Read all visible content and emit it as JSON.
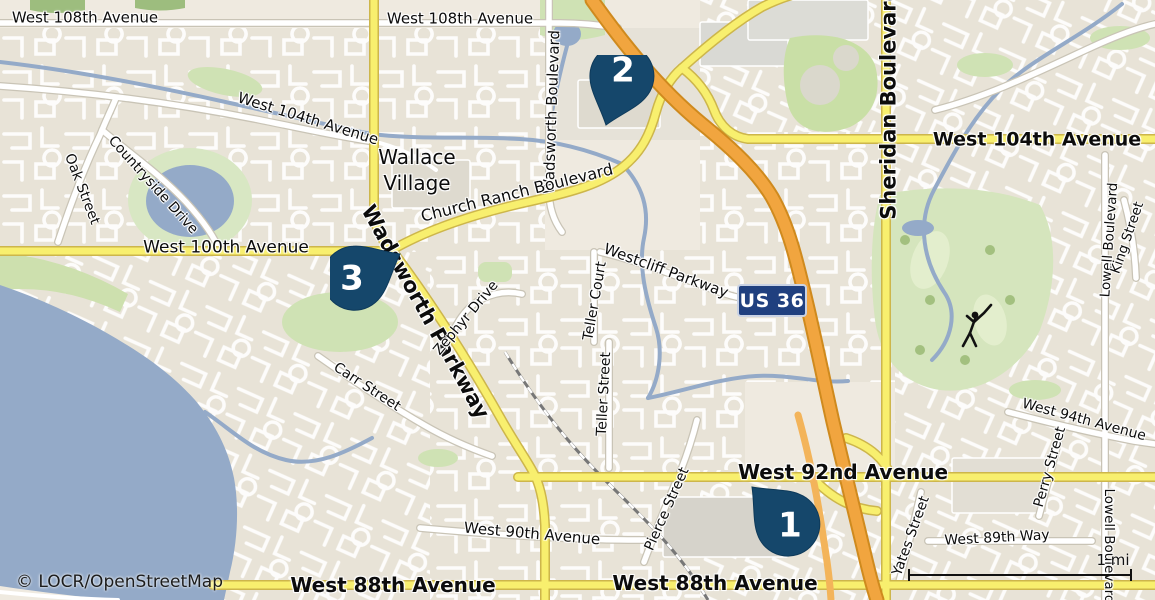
{
  "map": {
    "attribution": "© LOCR/OpenStreetMap",
    "scale_bar": {
      "label": "1 mi"
    },
    "route_shield": {
      "label": "US 36"
    },
    "markers": [
      {
        "number": "1"
      },
      {
        "number": "2"
      },
      {
        "number": "3"
      }
    ],
    "place_labels": {
      "wallace_village_line1": "Wallace",
      "wallace_village_line2": "Village"
    },
    "street_labels": {
      "w108_left": "West 108th Avenue",
      "w108_center": "West 108th Avenue",
      "w104_left": "West 104th Avenue",
      "w104_right": "West 104th Avenue",
      "countryside": "Countryside Drive",
      "oak": "Oak Street",
      "wadsworth_blvd": "Wadsworth Boulevard",
      "church_ranch": "Church Ranch Boulevard",
      "w100": "West 100th Avenue",
      "wadsworth_pkwy": "Wadsworth Parkway",
      "westcliff": "Westcliff Parkway",
      "teller_ct": "Teller Court",
      "teller_st": "Teller Street",
      "zephyr": "Zephyr Drive",
      "carr": "Carr Street",
      "pierce": "Pierce Street",
      "w90": "West 90th Avenue",
      "w88_left": "West 88th Avenue",
      "w88_center": "West 88th Avenue",
      "w92": "West 92nd Avenue",
      "yates": "Yates Street",
      "w89": "West 89th Way",
      "perry": "Perry Street",
      "w94": "West 94th Avenue",
      "lowell_north": "Lowell Boulevard",
      "king": "King Street",
      "lowell_south": "Lowell Boulevard",
      "sheridan": "Sheridan Boulevard"
    },
    "palette": {
      "marker_fill": "#15476b",
      "shield_fill": "#20407f",
      "motorway": "#f1a53f",
      "major_road": "#f8ef6e",
      "water": "#94aac8",
      "land": "#efeae0",
      "green": "#d8e7c3"
    }
  }
}
